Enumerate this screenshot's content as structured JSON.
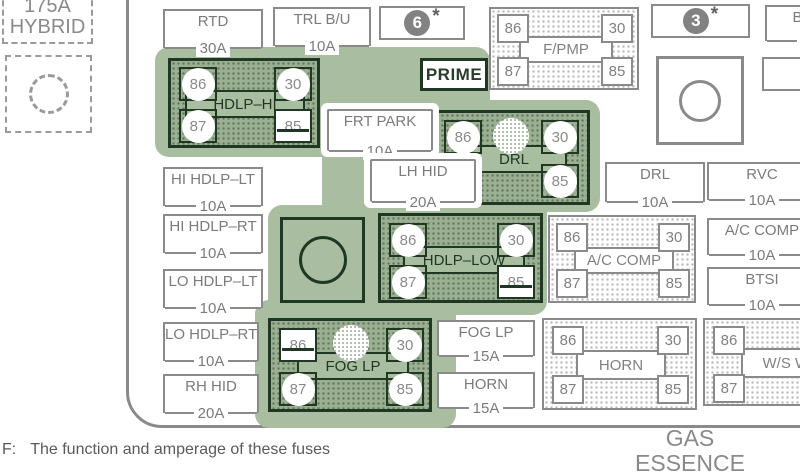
{
  "misc": {
    "hybrid_amps": "175A",
    "hybrid_name": "HYBRID",
    "prime": "PRIME",
    "num6": "6",
    "num3": "3",
    "star": "*",
    "gas": "GAS",
    "essence": "ESSENCE",
    "footnote_prefix": "F:",
    "footnote_text": "The function and amperage of these fuses"
  },
  "fuses": {
    "rtd": {
      "label": "RTD",
      "amps": "30A"
    },
    "trl_bu": {
      "label": "TRL B/U",
      "amps": "10A"
    },
    "bu_cut": {
      "label": "B/U",
      "amps": "2"
    },
    "frt_park": {
      "label": "FRT PARK",
      "amps": "10A"
    },
    "lh_hid": {
      "label": "LH HID",
      "amps": "20A"
    },
    "hi_hdlp_lt": {
      "label": "HI HDLP–LT",
      "amps": "10A"
    },
    "hi_hdlp_rt": {
      "label": "HI HDLP–RT",
      "amps": "10A"
    },
    "lo_hdlp_lt": {
      "label": "LO HDLP–LT",
      "amps": "10A"
    },
    "lo_hdlp_rt": {
      "label": "LO HDLP–RT",
      "amps": "10A"
    },
    "rh_hid": {
      "label": "RH HID",
      "amps": "20A"
    },
    "drl": {
      "label": "DRL",
      "amps": "10A"
    },
    "rvc": {
      "label": "RVC",
      "amps": "10A"
    },
    "ac_comp": {
      "label": "A/C COMP",
      "amps": "10A"
    },
    "btsi": {
      "label": "BTSI",
      "amps": "10A"
    },
    "fog_lp": {
      "label": "FOG LP",
      "amps": "15A"
    },
    "horn": {
      "label": "HORN",
      "amps": "15A"
    }
  },
  "relays": {
    "fpmp": {
      "label": "F/PMP",
      "t86": "86",
      "t30": "30",
      "t87": "87",
      "t85": "85"
    },
    "hdlp_hi": {
      "label": "HDLP–HI",
      "t86": "86",
      "t30": "30",
      "t87": "87",
      "t85": "85"
    },
    "drl": {
      "label": "DRL",
      "t86": "86",
      "t30": "30",
      "t87": "87",
      "t85": "85"
    },
    "hdlp_low": {
      "label": "HDLP–LOW",
      "t86": "86",
      "t30": "30",
      "t87": "87",
      "t85": "85"
    },
    "ac_comp": {
      "label": "A/C COMP",
      "t86": "86",
      "t30": "30",
      "t87": "87",
      "t85": "85"
    },
    "fog_lp": {
      "label": "FOG LP",
      "t86": "86",
      "t30": "30",
      "t87": "87",
      "t85": "85"
    },
    "horn": {
      "label": "HORN",
      "t86": "86",
      "t30": "30",
      "t87": "87",
      "t85": "85"
    },
    "ws_wash": {
      "label": "W/S WASH",
      "t86": "86",
      "t87": "87"
    }
  }
}
